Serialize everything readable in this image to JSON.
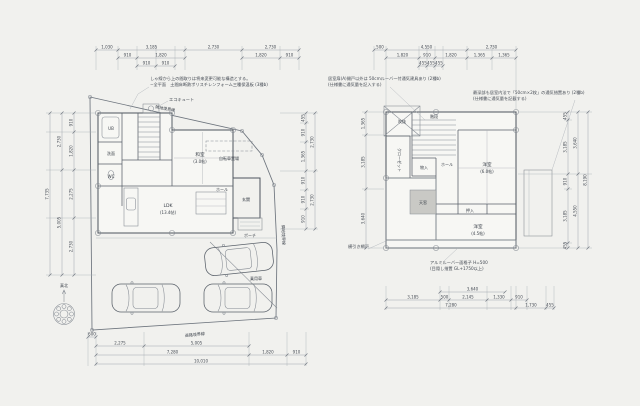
{
  "page": {
    "bg": "#f1f1ee",
    "line_color": "#848a92",
    "wall_color": "#4d545d",
    "text_color": "#3f454e"
  },
  "compass": {
    "label": "真北"
  },
  "left_plan": {
    "notes": {
      "line1": "しゃ線から上の間取りは将来変更可能な構造とする。",
      "line2": "−全平面　土間床断熱ポリスチレンフォーム三種保温板 (3種b)"
    },
    "boundary": {
      "top": "隣地境界線",
      "right": "隣地境界線",
      "bottom": "道路境界線"
    },
    "labels": {
      "ub": "UB",
      "senmen": "洗面",
      "wc": "WC",
      "washitsu": "和室",
      "washitsu_size": "(3.0帖)",
      "ldk": "LDK",
      "ldk_size": "(13.4帖)",
      "hall": "ホール",
      "genkan": "玄関",
      "porch": "ポーチ",
      "ecocute": "エコキュート",
      "bicycle": "自転車置場",
      "car": "乗用車"
    },
    "dims": {
      "top1": [
        "1,030",
        "3,185",
        "2,730",
        "2,730"
      ],
      "top2": [
        "910",
        "1,820",
        "1,820",
        "910"
      ],
      "top3": [
        "910",
        "910"
      ],
      "left1": [
        "910",
        "1,820",
        "2,275",
        "2,730"
      ],
      "left2": [
        "2,730",
        "5,005"
      ],
      "left3": [
        "7,735"
      ],
      "right1": [
        "455",
        "910",
        "1,365",
        "910",
        "910",
        "910"
      ],
      "right2": [
        "2,730",
        "2,730"
      ],
      "bottom0": "600",
      "bottom1": [
        "2,275",
        "5,005"
      ],
      "bottom2": [
        "7,280",
        "1,820",
        "910"
      ],
      "bottom3": "10,010"
    }
  },
  "right_plan": {
    "notes": {
      "tl1": "居室扉(A)開戸以外は 50cmルーバー付通気建具あり (2種b)",
      "tl2": "(仕様書に通気量を記入する)",
      "tr1": "最深部も居室内法で「50cm×2枚」の通気措置あり (2種b)",
      "tr2": "(仕様書に通気量を記載する)",
      "b1": "アルミルーバー面格子 H=500",
      "b2": "(目隠し措置 GL+1750以上)",
      "bl": "横引き網戸"
    },
    "labels": {
      "void": "吹抜",
      "closet": "クローゼット",
      "stairs": "階段",
      "hall": "ホール",
      "mono": "物入",
      "room1": "洋室",
      "room1_size": "(6.0帖)",
      "oshiire": "押入",
      "room2": "洋室",
      "room2_size": "(4.5帖)",
      "skylight": "天窓"
    },
    "dims": {
      "top0": "500",
      "top1": [
        "4,550",
        "2,730"
      ],
      "top2": [
        "1,820",
        "910",
        "1,820",
        "1,365",
        "1,365"
      ],
      "top3": [
        "455",
        "455",
        "455"
      ],
      "left1": [
        "1,365",
        "3,185",
        "3,640"
      ],
      "right1": [
        "455",
        "3,185",
        "910",
        "3,185",
        "455"
      ],
      "right2": [
        "3,640",
        "4,550"
      ],
      "right3": "8,190",
      "bottom0": "3,640",
      "bottom1": [
        "3,185",
        "500",
        "2,145",
        "1,330",
        "910"
      ],
      "bottom2": [
        "7,280",
        "1,730",
        "455"
      ]
    }
  }
}
